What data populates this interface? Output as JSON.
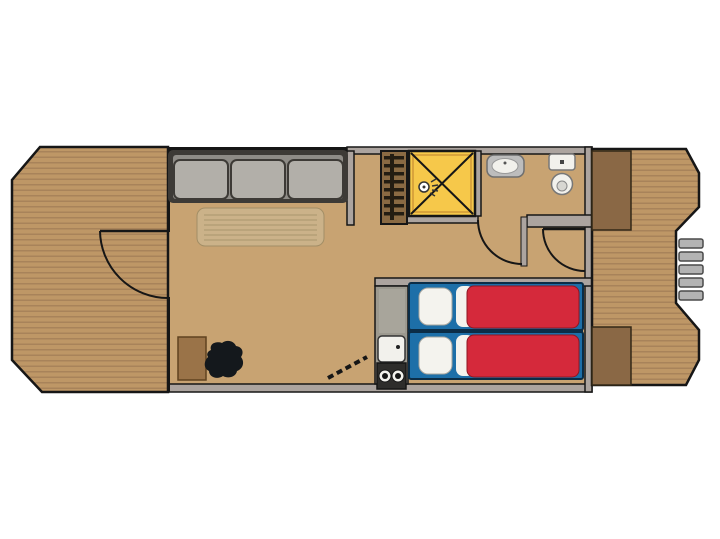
{
  "diagram": {
    "type": "houseboat-floor-plan",
    "orientation": "bow-left-stern-right",
    "areas": [
      {
        "id": "bow-deck",
        "label": "Bow deck",
        "surface": "wood-planks",
        "features": [
          "entry-door-swing"
        ]
      },
      {
        "id": "living-room",
        "label": "Living room",
        "furniture": [
          "sofa-3-seat",
          "table",
          "cabinet",
          "black-stove"
        ]
      },
      {
        "id": "wardrobe",
        "label": "Wardrobe",
        "features": [
          "hanger-bars"
        ]
      },
      {
        "id": "shower",
        "label": "Shower cabin",
        "features": [
          "x-marking",
          "shower-head"
        ]
      },
      {
        "id": "bathroom",
        "label": "Bathroom",
        "fixtures": [
          "sink",
          "toilet"
        ],
        "features": [
          "bathroom-door-swing"
        ]
      },
      {
        "id": "hallway",
        "label": "Hallway",
        "features": [
          "stern-door-swing"
        ]
      },
      {
        "id": "kitchenette",
        "label": "Kitchenette",
        "fixtures": [
          "kitchen-sink",
          "two-burner-stove"
        ],
        "features": [
          "step-hatch-dashed"
        ]
      },
      {
        "id": "bedroom",
        "label": "Bedroom",
        "furniture": [
          "single-bed-upper",
          "single-bed-lower"
        ],
        "bed_parts": [
          "pillow",
          "sheet",
          "red-duvet"
        ]
      },
      {
        "id": "stern-deck",
        "label": "Stern deck",
        "surface": "wood-planks",
        "features": [
          "storage-box-top",
          "storage-box-bottom",
          "boarding-steps"
        ],
        "boarding_steps_count": 5
      }
    ],
    "doors": [
      {
        "id": "bow-entry-door",
        "between": [
          "living-room",
          "bow-deck"
        ]
      },
      {
        "id": "bathroom-door",
        "between": [
          "hallway",
          "bathroom"
        ]
      },
      {
        "id": "stern-door",
        "between": [
          "hallway",
          "stern-deck"
        ]
      }
    ]
  },
  "colors": {
    "page_bg": "#ffffff",
    "deck_wood": "#BE9766",
    "deck_plank_line": "#A8835A",
    "floor_tan": "#C8A372",
    "wall_gray": "#ACA49F",
    "outline_black": "#161616",
    "sofa_frame": "#3D3A36",
    "sofa_back": "#8E8B86",
    "sofa_cushion": "#B2AFA9",
    "table_top": "#CBB289",
    "table_edge": "#A28E66",
    "table_line": "#B59F77",
    "wardrobe_brown": "#8A6A43",
    "wardrobe_bar": "#241D12",
    "shower_yellow": "#F6C84A",
    "shower_edge": "#D9A43B",
    "fixture_white": "#F2F1EC",
    "fixture_gray": "#BDBDBD",
    "kitchen_gray": "#9C998F",
    "kitchen_light": "#A8A59B",
    "stove_black": "#2E2D2B",
    "bed_blue": "#1D6FA8",
    "bed_outline": "#0B2D47",
    "duvet_red": "#D5293B",
    "duvet_edge": "#8E1622",
    "pillow_white": "#F4F3EE",
    "cabinet_brown": "#9A7348",
    "deck_box_brown": "#8A6845",
    "step_gray": "#B3B3B3",
    "blob_black": "#14181C"
  }
}
